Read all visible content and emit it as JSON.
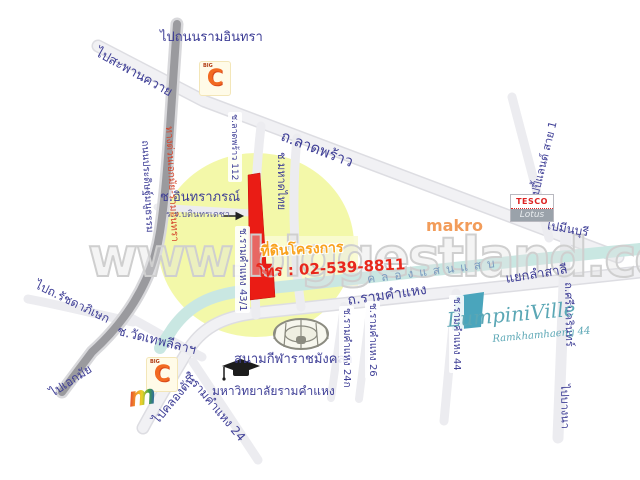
{
  "watermark": "www.biggestland.com",
  "project": {
    "label": "ที่ดินโครงการ",
    "phone": "โทร : 02-539-8811",
    "plot_soi": "ช.รามคำแหง 43/1"
  },
  "labels": {
    "to_ram_inthra": "ไปถนนรามอินทรา",
    "to_saphan_khwai": "ไปสะพานควาย",
    "lat_phrao": "ถ.ลาดพร้าว",
    "happy_land": "ถ.แฮปปี้แลนด์ สาย 1",
    "to_min_buri": "ไปมีนบุรี",
    "makro": "makro",
    "pradit_manutham": "ถนนประดิษฐ์มนูธรรม",
    "expressway": "ทางด่วนเอกมัย-รามอินทรา",
    "soi_intharaporn": "ช.อินทราภรณ์",
    "bodindecha_school": "ร.ร.บดินทรเดชา",
    "soi_lat_phrao_112": "ช.ลาดพร้าว 112",
    "soi_mahat_thai": "ช.มหาดไทย",
    "soi_ramkhamhaeng_43_1": "ช.รามคำแหง 43/1",
    "to_ratchadaphisek": "ไปถ.รัชดาภิเษก",
    "to_ekkamai": "ไปเอกมัย",
    "soi_wat_thep_lila": "ช.วัดเทพลีลาฯ",
    "to_khlong_tan": "ไปคลองตัน",
    "soi_ramkhamhaeng_24": "ช.รามคำแหง 24",
    "ramkhamhaeng_university": "มหาวิทยาลัยรามคำแหง",
    "rajamangala_stadium": "สนามกีฬาราชมังคลา",
    "soi_ramkhamhaeng_24k": "ช.รามคำแหง 24ก",
    "soi_ramkhamhaeng_26": "ช.รามคำแหง 26",
    "soi_ramkhamhaeng_44": "ช.รามคำแหง 44",
    "khlong_saen_saep": "คลองแสนแสบ",
    "ramkhamhaeng_road": "ถ.รามคำแหง",
    "lam_sali_intersection": "แยกลำสาลี",
    "srinagarindra": "ถ.ศรีนครินทร์",
    "to_bang_na": "ไปบางนา",
    "lumpini_ville": "LumpiniVille",
    "lumpini_sub": "Ramkhamhaeng 44"
  },
  "logos": {
    "big_c_letter": "C",
    "big_c_small": "BIG",
    "tesco": "TESCO",
    "lotus": "Lotus",
    "the_mall_letter": "m"
  },
  "colors": {
    "plot_red": "#ea1c15",
    "plot_teal": "#4aa5bc",
    "canal": "#c9e7e2",
    "highlight_circle": "#f2f7a0",
    "road_fill": "#efeff2",
    "expressway_gray": "#9a9a9e",
    "label_blue": "#3e3e96",
    "phone_red": "#e8271c",
    "project_orange": "#f9a21d",
    "makro_orange": "#f08432",
    "bigc_orange": "#f26a21",
    "lumpini_teal": "#5ba7b5"
  }
}
